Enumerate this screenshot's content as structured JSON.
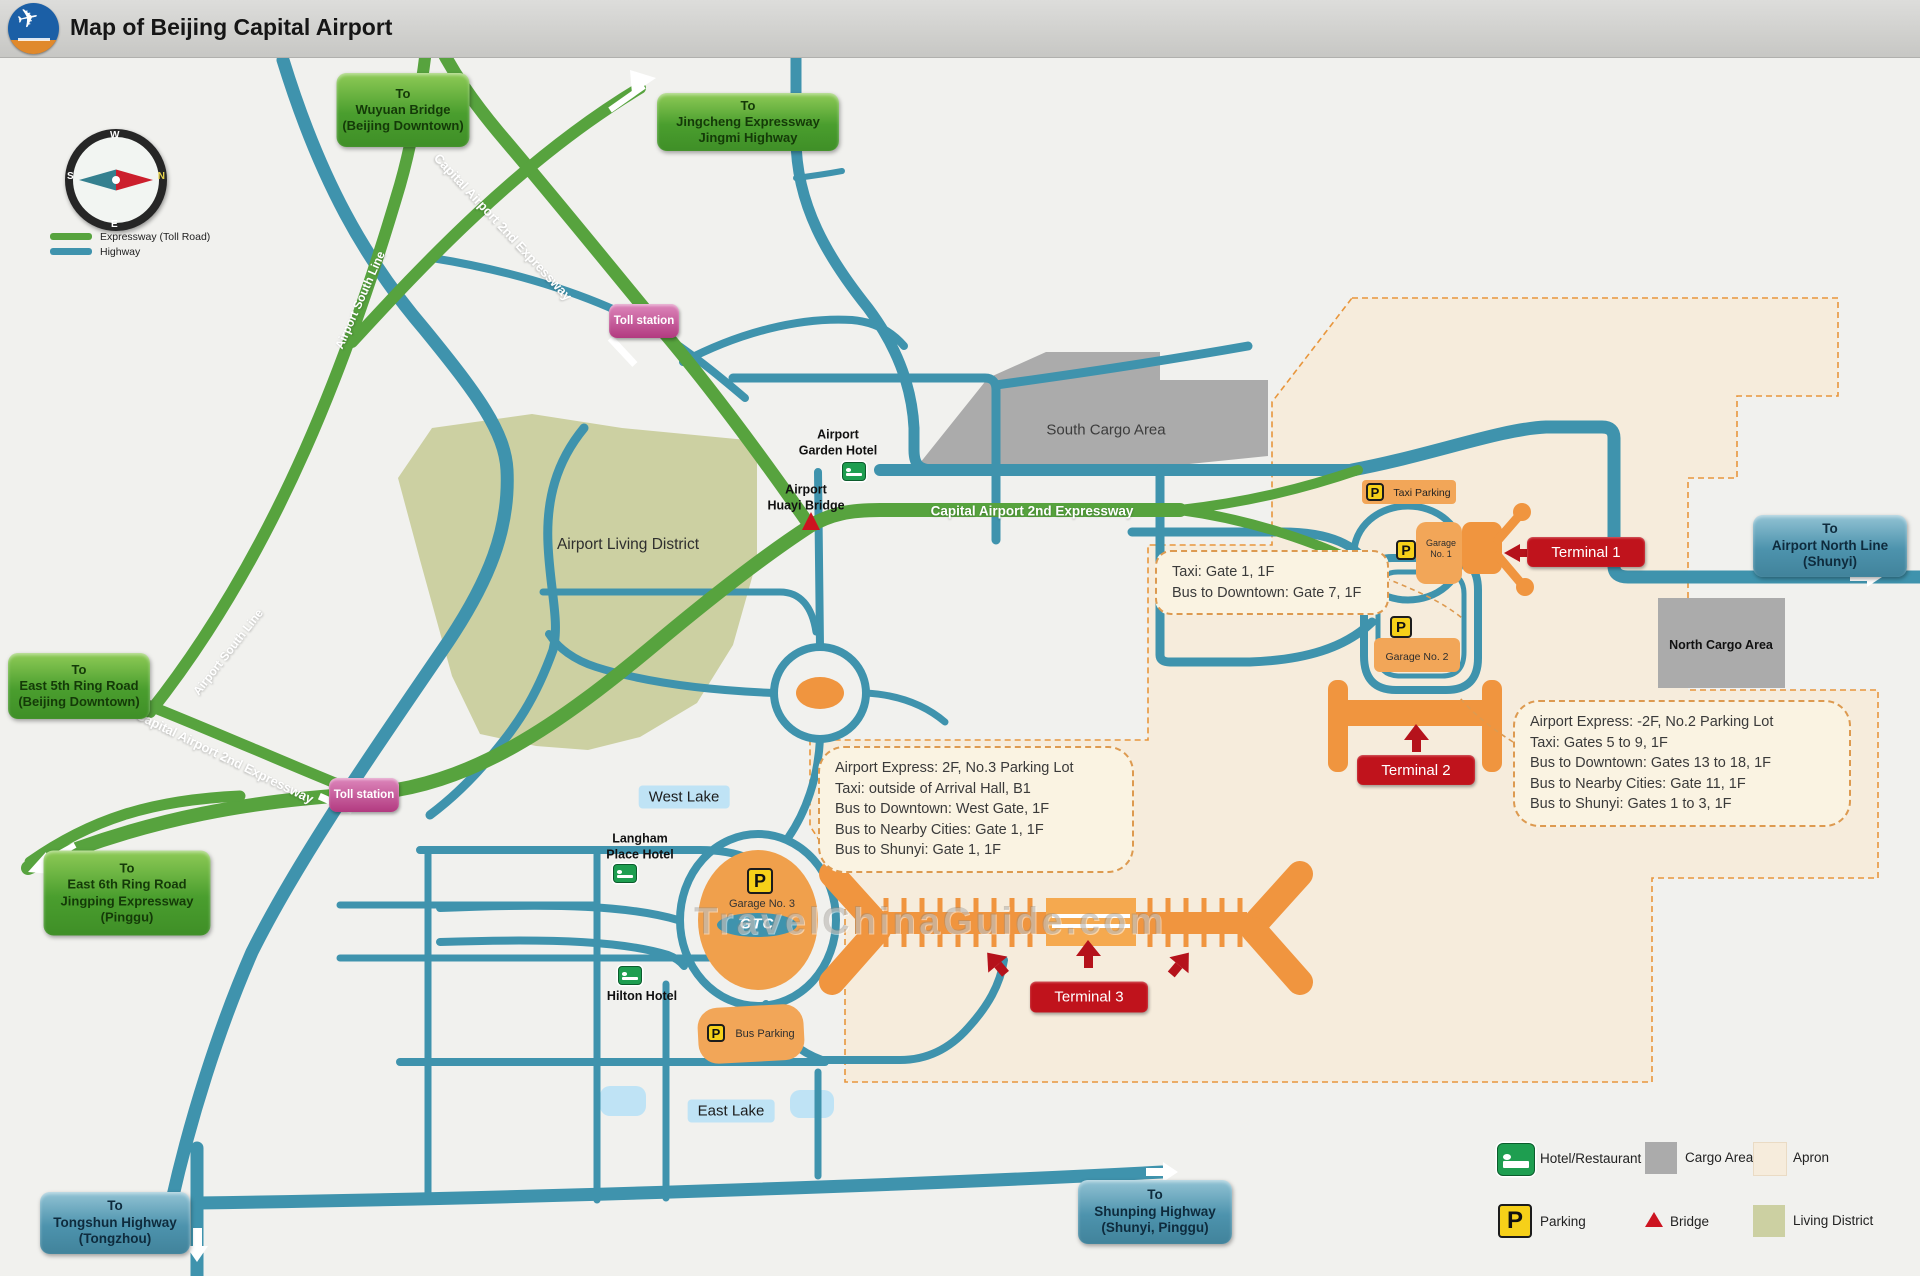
{
  "header": {
    "title": "Map of Beijing Capital Airport"
  },
  "legend_top": {
    "expressway": "Expressway (Toll Road)",
    "highway": "Highway"
  },
  "compass": {
    "n": "N",
    "s": "S",
    "e": "E",
    "w": "W"
  },
  "signs": {
    "wuyuan": {
      "lines": [
        "To",
        "Wuyuan Bridge",
        "(Beijing Downtown)"
      ]
    },
    "jingcheng": {
      "lines": [
        "To",
        "Jingcheng Expressway",
        "Jingmi Highway"
      ]
    },
    "east5th": {
      "lines": [
        "To",
        "East 5th Ring Road",
        "(Beijing Downtown)"
      ]
    },
    "east6th": {
      "lines": [
        "To",
        "East 6th Ring Road",
        "Jingping Expressway",
        "(Pinggu)"
      ]
    },
    "north_line": {
      "lines": [
        "To",
        "Airport North Line",
        "(Shunyi)"
      ]
    },
    "tongshun": {
      "lines": [
        "To",
        "Tongshun Highway",
        "(Tongzhou)"
      ]
    },
    "shunping": {
      "lines": [
        "To",
        "Shunping Highway",
        "(Shunyi, Pinggu)"
      ]
    }
  },
  "toll_station": {
    "label": "Toll station"
  },
  "road_labels": {
    "capital_expwy": "Capital Airport 2nd Expressway",
    "airport_south": "Airport South Line"
  },
  "areas": {
    "living": "Airport Living District",
    "south_cargo": "South Cargo Area",
    "north_cargo": "North Cargo Area",
    "west_lake": "West Lake",
    "east_lake": "East Lake"
  },
  "terminals": {
    "t1": "Terminal 1",
    "t2": "Terminal 2",
    "t3": "Terminal 3"
  },
  "parking": {
    "taxi": "Taxi Parking",
    "g1_line1": "Garage",
    "g1_line2": "No. 1",
    "g2": "Garage No. 2",
    "g3": "Garage No. 3",
    "bus": "Bus Parking",
    "gtc": "GTC",
    "p": "P"
  },
  "hotels": {
    "garden": {
      "lines": [
        "Airport",
        "Garden Hotel"
      ]
    },
    "langham": {
      "lines": [
        "Langham",
        "Place Hotel"
      ]
    },
    "hilton": "Hilton Hotel"
  },
  "bridge": {
    "huayi": {
      "lines": [
        "Airport",
        "Huayi Bridge"
      ]
    }
  },
  "info_boxes": {
    "t1": {
      "lines": [
        "Taxi: Gate 1, 1F",
        "Bus to Downtown: Gate 7, 1F"
      ]
    },
    "t3": {
      "lines": [
        "Airport Express: 2F, No.3 Parking Lot",
        "Taxi: outside of Arrival Hall, B1",
        "Bus to Downtown: West Gate, 1F",
        "Bus to Nearby Cities: Gate 1, 1F",
        "Bus to Shunyi: Gate 1, 1F"
      ]
    },
    "t2": {
      "lines": [
        "Airport Express: -2F, No.2 Parking Lot",
        "Taxi: Gates 5 to 9, 1F",
        "Bus to Downtown: Gates 13 to 18, 1F",
        "Bus to Nearby Cities: Gate 11, 1F",
        "Bus to Shunyi: Gates 1 to 3, 1F"
      ]
    }
  },
  "legend_bottom": {
    "hotel": "Hotel/Restaurant",
    "cargo": "Cargo Area",
    "apron": "Apron",
    "parking": "Parking",
    "bridge": "Bridge",
    "living": "Living District"
  },
  "watermark": "TravelChinaGuide.com",
  "colors": {
    "expressway_green": "#57a33e",
    "highway_blue": "#3f93ad",
    "apron_cream": "#f6ecdc",
    "cargo_gray": "#ababab",
    "living_olive": "#ccd0a2",
    "terminal_red": "#c0131c",
    "building_orange": "#f0953f",
    "parking_yellow": "#f6d019",
    "toll_magenta": "#b23a80",
    "lake_blue": "#bfe3f5"
  }
}
